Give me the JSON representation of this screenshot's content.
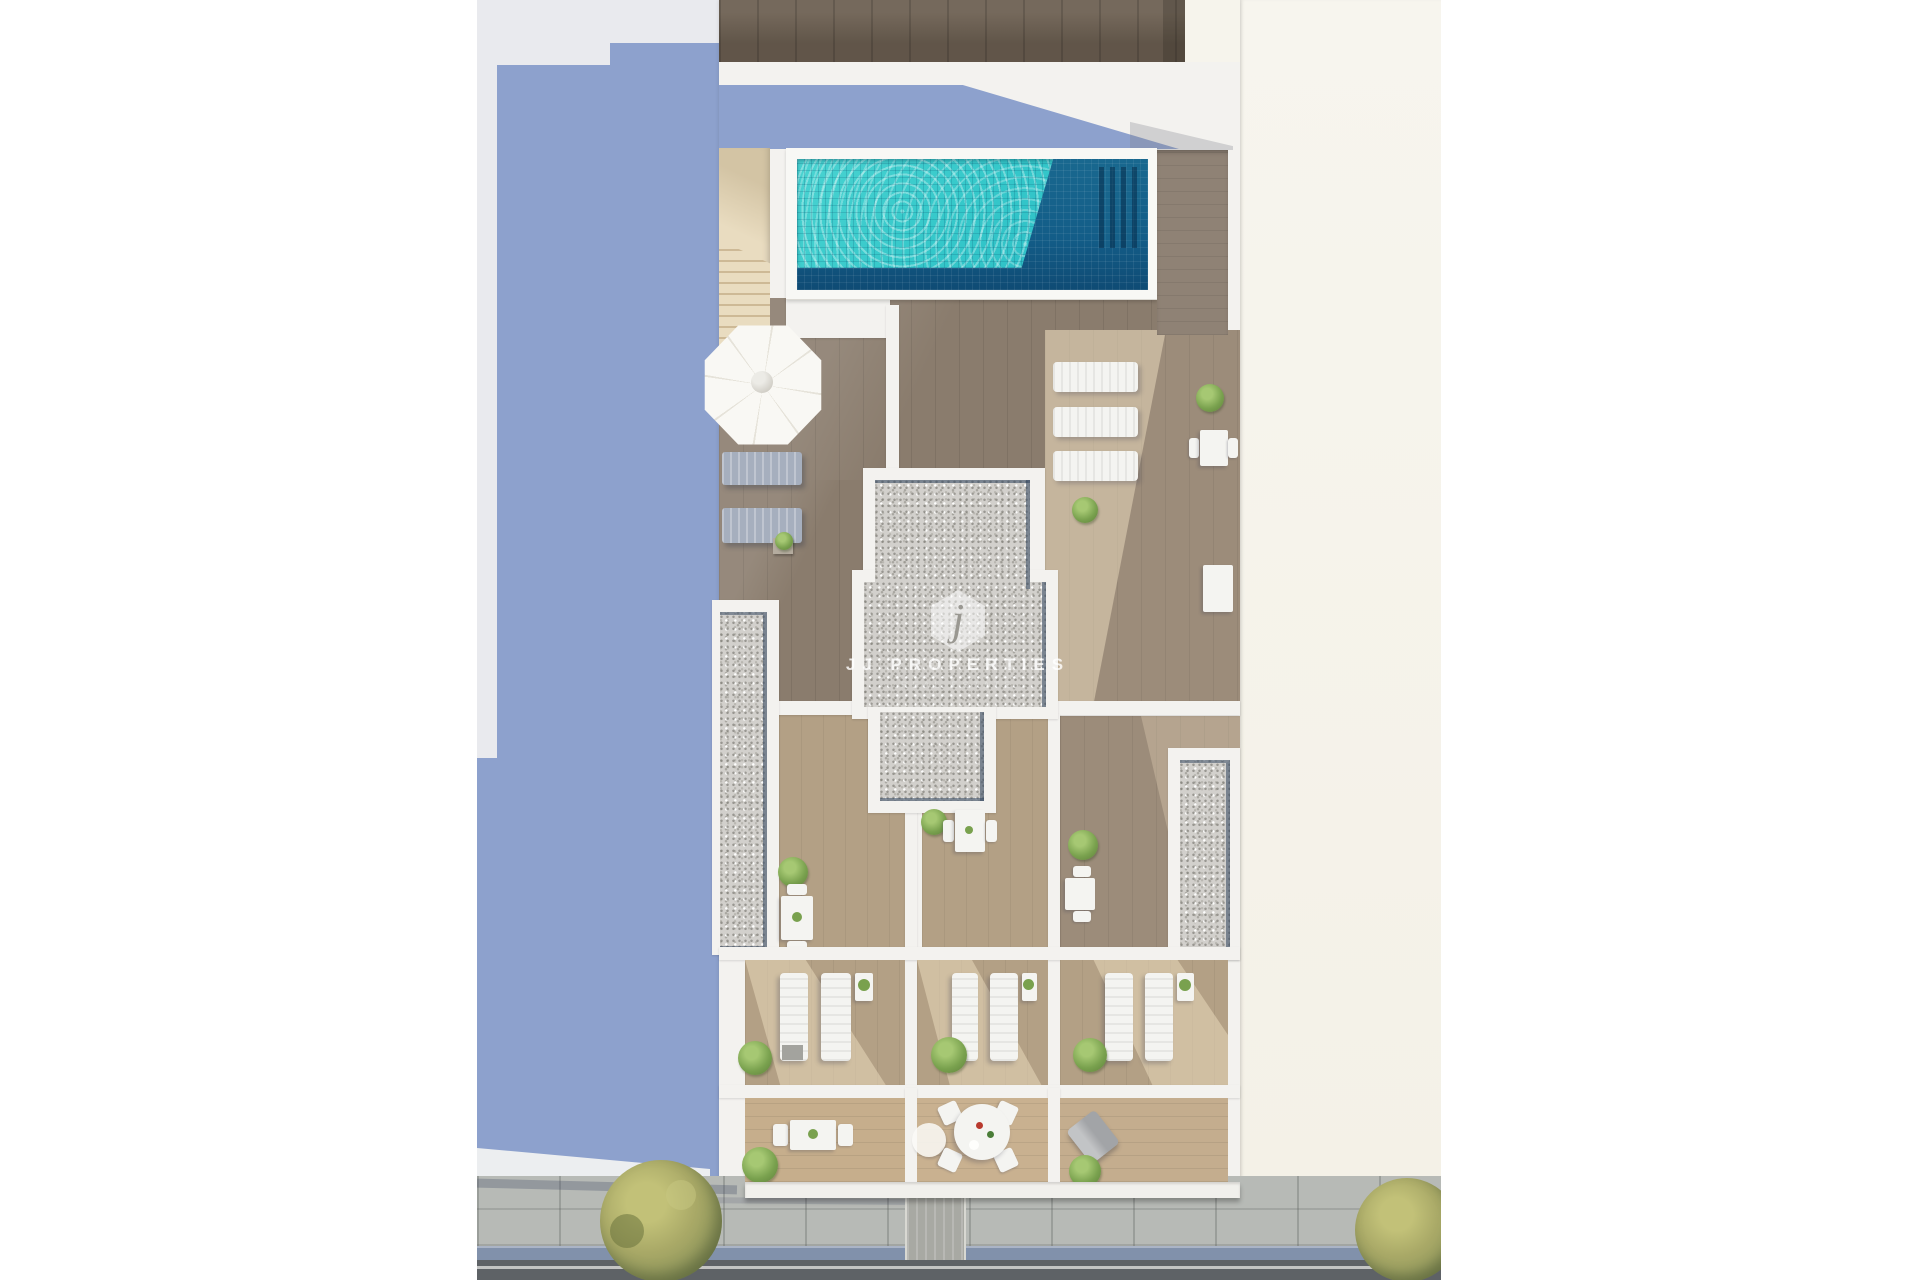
{
  "scene": {
    "type": "aerial-architectural-render",
    "description": "Top-down 3D render of a residential rooftop floor plan with swimming pool, wood terraces, gravel roof core, sun loungers, private bedroom terraces, street-side balconies, and a street with sidewalk and trees below",
    "areas": [
      {
        "id": "neighbor-roof-left",
        "label": "adjacent building roof in blue shadow"
      },
      {
        "id": "neighbor-roof-right",
        "label": "adjacent cream building roof"
      },
      {
        "id": "rooftop-wood-edge",
        "label": "dark wood deck strip at top"
      },
      {
        "id": "swimming-pool",
        "label": "tiled rooftop swimming pool"
      },
      {
        "id": "pool-stairs",
        "label": "beige access stair beside pool"
      },
      {
        "id": "pool-terrace",
        "label": "shaded wood pool terrace with parasol and loungers"
      },
      {
        "id": "roof-core",
        "label": "central gravel roof core with watermark"
      },
      {
        "id": "right-terrace",
        "label": "sunlit terrace with three white loungers"
      },
      {
        "id": "patios",
        "label": "two private patios with dining sets"
      },
      {
        "id": "bedroom-terraces",
        "label": "three terraces with paired sun loungers"
      },
      {
        "id": "balconies",
        "label": "three street-side balconies with furniture"
      },
      {
        "id": "street",
        "label": "sidewalk, blue gutter, asphalt road and trees"
      }
    ],
    "furniture_counts": {
      "parasol": 1,
      "grey_loungers": 2,
      "white_loungers_horizontal": 3,
      "white_lounger_pairs": 3,
      "dining_sets": 5,
      "round_table_chairs": 4,
      "street_trees": 2
    }
  },
  "watermark": {
    "logo_letter": "j",
    "title": "JJ PROPERTIES",
    "subtitle": "REAL ESTATE"
  },
  "colors": {
    "shadow_blue": "#8da1cd",
    "neighbor_grey": "#e9eaee",
    "neighbor_cream": "#f6f4ec",
    "wall_white": "#f3f2ef",
    "top_deck": "#6e6153",
    "pool_bright": "#35c8ca",
    "pool_light": "#7fe3de",
    "pool_deep": "#19688f",
    "pool_floor": "#0f4b74",
    "stairs_beige": "#e9dcc0",
    "wood_dark": "#8a7c6d",
    "wood_mid": "#9c8c7a",
    "wood_light": "#b3a085",
    "wood_sunlit": "#d3bd9a",
    "gravel": "#d2d0cc",
    "glass_navy": "#31455f",
    "umbrella_white": "#f9f8f4",
    "lounger_grey": "#a6afbe",
    "furniture_white": "#f4f4f1",
    "bush_green": "#79a14e",
    "tree_olive": "#a9a967",
    "sidewalk": "#b7bab6",
    "gutter_blue": "#8191ab",
    "asphalt": "#5e6266",
    "driveway": "#a8a9a3"
  }
}
